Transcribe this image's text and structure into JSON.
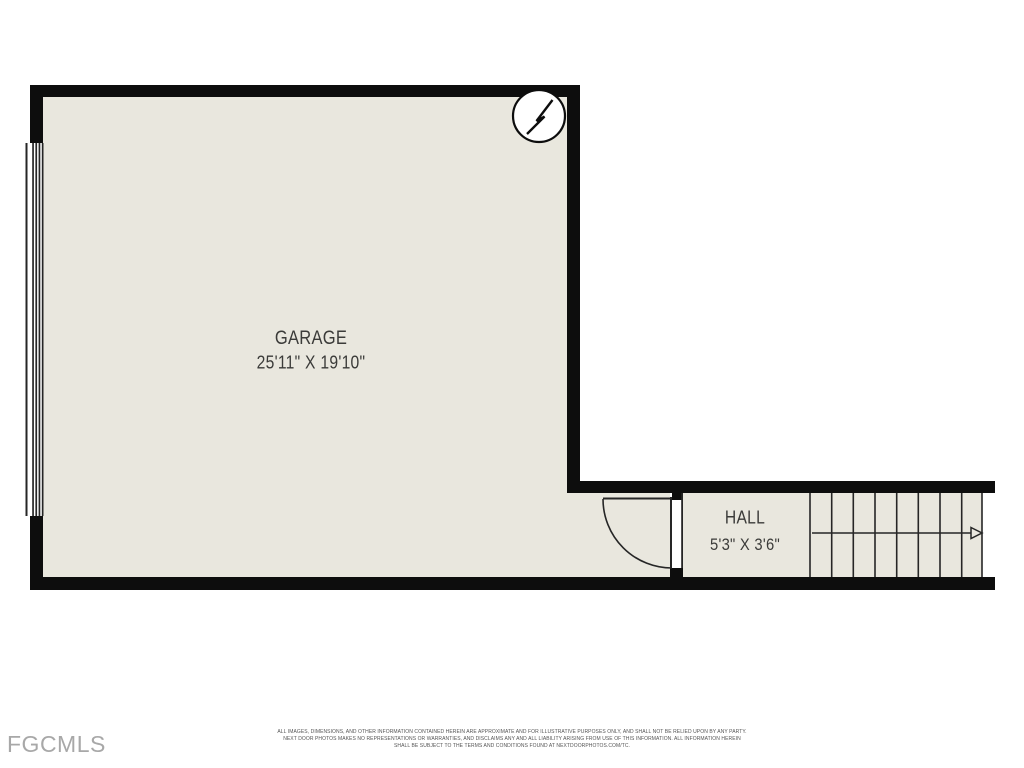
{
  "floorplan": {
    "rooms": [
      {
        "name": "GARAGE",
        "dimensions": "25'11\" X 19'10\""
      },
      {
        "name": "HALL",
        "dimensions": "5'3\" X 3'6\""
      }
    ],
    "icons": {
      "north_arrow": "north-arrow-compass",
      "stairs_arrow": "stairs-direction-arrow",
      "garage_door": "garage-door-panel",
      "swing_door": "door-with-swing-arc",
      "stairs": "staircase-treads"
    },
    "colors": {
      "floor": "#e9e7de",
      "wall": "#0d0d0d",
      "line": "#262626",
      "label": "#3b3b39",
      "watermark": "#a8a8a8",
      "disclaimer": "#555555",
      "bg": "#ffffff"
    }
  },
  "watermark": {
    "text": "FGCMLS"
  },
  "disclaimer": {
    "lines": [
      "ALL IMAGES, DIMENSIONS, AND OTHER INFORMATION CONTAINED HEREIN ARE APPROXIMATE AND FOR ILLUSTRATIVE PURPOSES ONLY, AND SHALL NOT BE RELIED UPON BY ANY PARTY.",
      "NEXT DOOR PHOTOS MAKES NO REPRESENTATIONS OR WARRANTIES, AND DISCLAIMS ANY AND ALL LIABILITY ARISING FROM USE OF THIS INFORMATION. ALL INFORMATION HEREIN",
      "SHALL BE SUBJECT TO THE TERMS AND CONDITIONS FOUND AT NEXTDOORPHOTOS.COM/TC."
    ]
  }
}
